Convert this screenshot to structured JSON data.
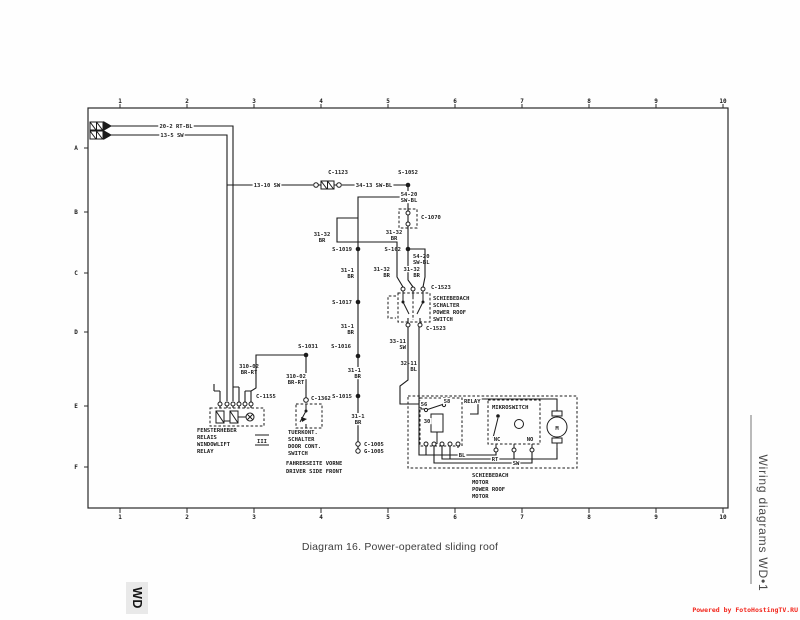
{
  "page": {
    "caption": "Diagram 16. Power-operated sliding roof",
    "side_label": "Wiring diagrams WD•1",
    "corner_tab": "WD",
    "watermark": "Powered by FotoHostingTV.RU",
    "colors": {
      "ink": "#1b1b1b",
      "watermark_red": "#f2251b",
      "tab_bg": "#e9e9e9"
    }
  },
  "grid": {
    "columns": [
      "1",
      "2",
      "3",
      "4",
      "5",
      "6",
      "7",
      "8",
      "9",
      "10"
    ],
    "rows": [
      {
        "t": "A",
        "y": 148
      },
      {
        "t": "B",
        "y": 212
      },
      {
        "t": "C",
        "y": 273
      },
      {
        "t": "D",
        "y": 332
      },
      {
        "t": "E",
        "y": 406
      },
      {
        "t": "F",
        "y": 467
      }
    ]
  },
  "diagram": {
    "labels": [
      {
        "t": "20-2 RT-BL",
        "x": 176,
        "y": 128,
        "a": "m",
        "b": 1
      },
      {
        "t": "13-5 SW",
        "x": 172,
        "y": 137,
        "a": "m",
        "b": 1
      },
      {
        "t": "13-10 SW",
        "x": 267,
        "y": 187,
        "a": "m",
        "b": 1
      },
      {
        "t": "C-1123",
        "x": 338,
        "y": 174,
        "a": "m"
      },
      {
        "t": "34-13 SW-BL",
        "x": 374,
        "y": 187,
        "a": "m",
        "b": 1
      },
      {
        "t": "S-1052",
        "x": 408,
        "y": 174,
        "a": "m",
        "b": 1
      },
      {
        "t": "54-20",
        "x": 409,
        "y": 196,
        "a": "m",
        "b": 1
      },
      {
        "t": "SW-BL",
        "x": 409,
        "y": 202,
        "a": "m",
        "b": 1
      },
      {
        "t": "C-1070",
        "x": 421,
        "y": 219,
        "a": "s"
      },
      {
        "t": "S-162",
        "x": 401,
        "y": 251,
        "a": "e"
      },
      {
        "t": "54-20",
        "x": 413,
        "y": 258,
        "a": "s"
      },
      {
        "t": "SW-BL",
        "x": 413,
        "y": 264,
        "a": "s"
      },
      {
        "t": "31-32",
        "x": 322,
        "y": 236,
        "a": "m"
      },
      {
        "t": "BR",
        "x": 322,
        "y": 242,
        "a": "m"
      },
      {
        "t": "31-32",
        "x": 394,
        "y": 234,
        "a": "m",
        "b": 1
      },
      {
        "t": "BR",
        "x": 394,
        "y": 240,
        "a": "m",
        "b": 1
      },
      {
        "t": "31-32",
        "x": 390,
        "y": 271,
        "a": "e"
      },
      {
        "t": "BR",
        "x": 390,
        "y": 277,
        "a": "e"
      },
      {
        "t": "31-32",
        "x": 420,
        "y": 271,
        "a": "e",
        "b": 1
      },
      {
        "t": "BR",
        "x": 420,
        "y": 277,
        "a": "e",
        "b": 1
      },
      {
        "t": "C-1523",
        "x": 431,
        "y": 289,
        "a": "s"
      },
      {
        "t": "SCHIEBEDACH",
        "x": 433,
        "y": 300,
        "a": "s"
      },
      {
        "t": "SCHALTER",
        "x": 433,
        "y": 307,
        "a": "s"
      },
      {
        "t": "POWER ROOF",
        "x": 433,
        "y": 314,
        "a": "s"
      },
      {
        "t": "SWITCH",
        "x": 433,
        "y": 321,
        "a": "s"
      },
      {
        "t": "C-1523",
        "x": 426,
        "y": 330,
        "a": "s"
      },
      {
        "t": "33-11",
        "x": 406,
        "y": 343,
        "a": "e"
      },
      {
        "t": "SW",
        "x": 406,
        "y": 349,
        "a": "e"
      },
      {
        "t": "32-11",
        "x": 417,
        "y": 365,
        "a": "e"
      },
      {
        "t": "BL",
        "x": 417,
        "y": 371,
        "a": "e"
      },
      {
        "t": "S-1019",
        "x": 352,
        "y": 251,
        "a": "e"
      },
      {
        "t": "31-1",
        "x": 354,
        "y": 272,
        "a": "e"
      },
      {
        "t": "BR",
        "x": 354,
        "y": 278,
        "a": "e"
      },
      {
        "t": "S-1017",
        "x": 352,
        "y": 304,
        "a": "e"
      },
      {
        "t": "31-1",
        "x": 354,
        "y": 328,
        "a": "e"
      },
      {
        "t": "BR",
        "x": 354,
        "y": 334,
        "a": "e"
      },
      {
        "t": "S-1016",
        "x": 351,
        "y": 348,
        "a": "e"
      },
      {
        "t": "31-1",
        "x": 361,
        "y": 372,
        "a": "e",
        "b": 1
      },
      {
        "t": "BR",
        "x": 361,
        "y": 378,
        "a": "e",
        "b": 1
      },
      {
        "t": "S-1015",
        "x": 352,
        "y": 398,
        "a": "e"
      },
      {
        "t": "31-1",
        "x": 358,
        "y": 418,
        "a": "m",
        "b": 1
      },
      {
        "t": "BR",
        "x": 358,
        "y": 424,
        "a": "m",
        "b": 1
      },
      {
        "t": "C-1005",
        "x": 364,
        "y": 446,
        "a": "s"
      },
      {
        "t": "G-1005",
        "x": 364,
        "y": 453,
        "a": "s"
      },
      {
        "t": "S-1031",
        "x": 308,
        "y": 348,
        "a": "m"
      },
      {
        "t": "310-02",
        "x": 249,
        "y": 368,
        "a": "m"
      },
      {
        "t": "BR-RT",
        "x": 249,
        "y": 374,
        "a": "m"
      },
      {
        "t": "310-02",
        "x": 296,
        "y": 378,
        "a": "m",
        "b": 1
      },
      {
        "t": "BR-RT",
        "x": 296,
        "y": 384,
        "a": "m",
        "b": 1
      },
      {
        "t": "C-1155",
        "x": 256,
        "y": 398,
        "a": "s"
      },
      {
        "t": "FENSTERHEBER",
        "x": 197,
        "y": 432,
        "a": "s"
      },
      {
        "t": "RELAIS",
        "x": 197,
        "y": 439,
        "a": "s"
      },
      {
        "t": "WINDOWLIFT",
        "x": 197,
        "y": 446,
        "a": "s"
      },
      {
        "t": "RELAY",
        "x": 197,
        "y": 453,
        "a": "s"
      },
      {
        "t": "C-1362",
        "x": 311,
        "y": 400,
        "a": "s"
      },
      {
        "t": "TUERKONT.",
        "x": 288,
        "y": 434,
        "a": "s"
      },
      {
        "t": "SCHALTER",
        "x": 288,
        "y": 441,
        "a": "s"
      },
      {
        "t": "DOOR CONT.",
        "x": 288,
        "y": 448,
        "a": "s"
      },
      {
        "t": "SWITCH",
        "x": 288,
        "y": 455,
        "a": "s"
      },
      {
        "t": "FAHRERSEITE VORNE",
        "x": 286,
        "y": 465,
        "a": "s"
      },
      {
        "t": "DRIVER SIDE FRONT",
        "x": 286,
        "y": 473,
        "a": "s"
      },
      {
        "t": "RELAY",
        "x": 464,
        "y": 403,
        "a": "s",
        "b": 1
      },
      {
        "t": "MIKROSWITCH",
        "x": 492,
        "y": 409,
        "a": "s",
        "b": 1
      },
      {
        "t": "56",
        "x": 424,
        "y": 406,
        "a": "m",
        "b": 1
      },
      {
        "t": "58",
        "x": 447,
        "y": 403,
        "a": "m",
        "b": 1
      },
      {
        "t": "30",
        "x": 427,
        "y": 423,
        "a": "m",
        "b": 1
      },
      {
        "t": "NC",
        "x": 497,
        "y": 441,
        "a": "m",
        "b": 1
      },
      {
        "t": "NO",
        "x": 530,
        "y": 441,
        "a": "m",
        "b": 1
      },
      {
        "t": "BL",
        "x": 462,
        "y": 457,
        "a": "m",
        "b": 1
      },
      {
        "t": "RT",
        "x": 495,
        "y": 461,
        "a": "m",
        "b": 1
      },
      {
        "t": "SW",
        "x": 516,
        "y": 465,
        "a": "m",
        "b": 1
      },
      {
        "t": "SCHIEBEDACH",
        "x": 472,
        "y": 477,
        "a": "s"
      },
      {
        "t": "MOTOR",
        "x": 472,
        "y": 484,
        "a": "s"
      },
      {
        "t": "POWER ROOF",
        "x": 472,
        "y": 491,
        "a": "s"
      },
      {
        "t": "MOTOR",
        "x": 472,
        "y": 498,
        "a": "s"
      },
      {
        "t": "M",
        "x": 557,
        "y": 430,
        "a": "m",
        "fs": 7
      },
      {
        "t": "III",
        "x": 262,
        "y": 443,
        "a": "m",
        "fs": 6.5
      }
    ]
  }
}
